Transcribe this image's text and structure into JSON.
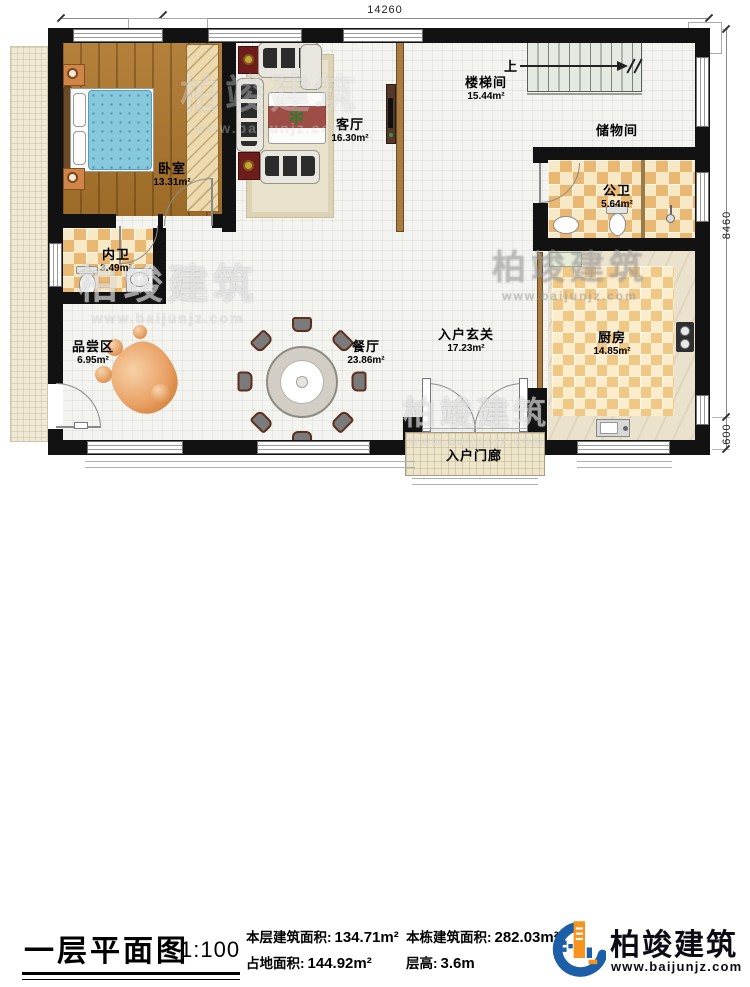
{
  "plan": {
    "dimensions": {
      "top": "14260",
      "right": "8460",
      "right_lower": "600"
    },
    "stairs_up": "上",
    "rooms": {
      "bedroom": {
        "name": "卧室",
        "area": "13.31m²"
      },
      "living": {
        "name": "客厅",
        "area": "16.30m²"
      },
      "stairwell": {
        "name": "楼梯间",
        "area": "15.44m²"
      },
      "storage": {
        "name": "储物间"
      },
      "public_bath": {
        "name": "公卫",
        "area": "5.64m²"
      },
      "private_bath": {
        "name": "内卫",
        "area": "3.49m²"
      },
      "tasting": {
        "name": "品尝区",
        "area": "6.95m²"
      },
      "dining": {
        "name": "餐厅",
        "area": "23.86m²"
      },
      "foyer": {
        "name": "入户玄关",
        "area": "17.23m²"
      },
      "kitchen": {
        "name": "厨房",
        "area": "14.85m²"
      },
      "porch": {
        "name": "入户门廊"
      }
    },
    "watermark": {
      "name": "柏竣建筑",
      "url": "www.baijunjz.com"
    }
  },
  "title_block": {
    "title": "一层平面图",
    "scale": "1:100",
    "stats": [
      {
        "label": "本层建筑面积:",
        "value": "134.71m²"
      },
      {
        "label": "占地面积:",
        "value": "144.92m²"
      },
      {
        "label": "本栋建筑面积:",
        "value": "282.03m²"
      },
      {
        "label": "层高:",
        "value": "3.6m"
      }
    ],
    "brand": {
      "name": "柏竣建筑",
      "url": "www.baijunjz.com"
    }
  },
  "icons": {
    "plant": "✻"
  },
  "colors": {
    "wall": "#121212",
    "wood": "#a9772e",
    "checker_dark": "#e9b873",
    "checker_light": "#f7e8c6",
    "brand_blue": "#1c5fa8",
    "brand_orange": "#f7941d"
  }
}
